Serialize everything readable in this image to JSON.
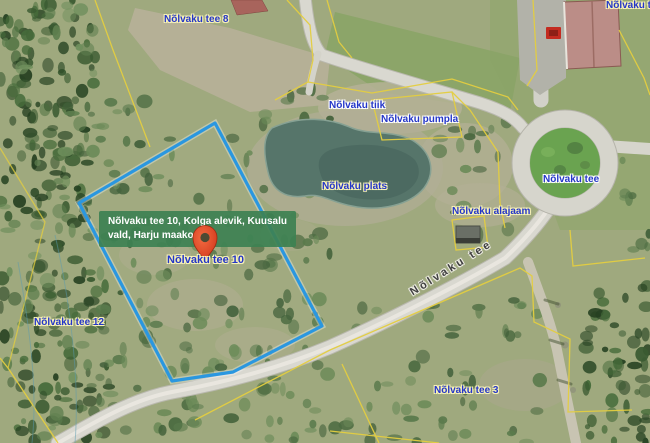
{
  "map": {
    "tooltip": {
      "line1": "Nõlvaku tee 10, Kolga alevik, Kuusalu",
      "line2": "vald, Harju maakond"
    },
    "marker": {
      "label": "Nõlvaku tee 10"
    },
    "labels": {
      "tee8": "Nõlvaku tee 8",
      "top_right_cutoff": "Nõlvaku tee",
      "tiik": "Nõlvaku tiik",
      "pumpla": "Nõlvaku pumpla",
      "plats": "Nõlvaku plats",
      "tee_roundabout": "Nõlvaku tee",
      "alajaam": "Nõlvaku alajaam",
      "tee12": "Nõlvaku tee 12",
      "tee3": "Nõlvaku tee 3",
      "road": "Nõlvaku tee"
    },
    "colors": {
      "selected_parcel_outline": "#2a97e0",
      "cadastral_boundary": "#e4ce40",
      "marker_pin": "#e0452a",
      "tooltip_background": "#3d8153",
      "label_text": "#2436c8"
    }
  }
}
